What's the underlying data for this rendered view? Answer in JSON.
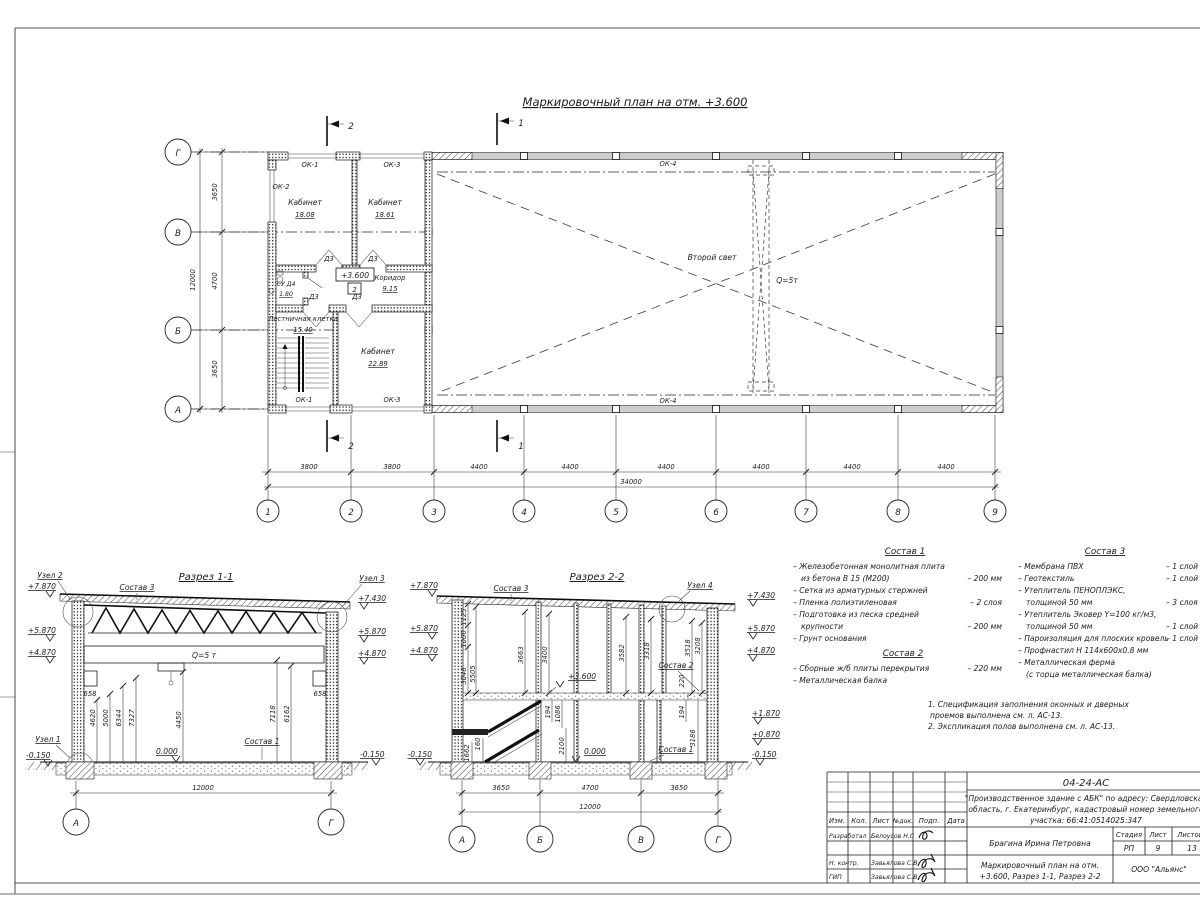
{
  "titles": {
    "plan": "Маркировочный план на отм. +3.600",
    "section1": "Разрез 1-1",
    "section2": "Разрез 2-2"
  },
  "plan": {
    "rooms": {
      "kab1_name": "Кабинет",
      "kab1_area": "18.08",
      "kab2_name": "Кабинет",
      "kab2_area": "18.61",
      "su_name": "СУ Д4",
      "su_area": "1.80",
      "corridor_name": "Коридор",
      "corridor_area": "9.15",
      "stair_name": "Лестничная клетка",
      "stair_area": "15.40",
      "kab3_name": "Кабинет",
      "kab3_area": "22.89"
    },
    "window_ok1": "ОК-1",
    "window_ok2": "ОК-2",
    "window_ok3": "ОК-3",
    "window_ok4": "ОК-4",
    "door": "Д3",
    "level_node": "2",
    "second_light": "Второй свет",
    "crane": "Q=5т",
    "cut1": "1",
    "cut2": "2",
    "axes_bottom": [
      "1",
      "2",
      "3",
      "4",
      "5",
      "6",
      "7",
      "8",
      "9"
    ],
    "axes_left": [
      "Г",
      "В",
      "Б",
      "А"
    ],
    "dims_bottom": [
      "3800",
      "3800",
      "4400",
      "4400",
      "4400",
      "4400",
      "4400",
      "4400"
    ],
    "dims_bottom_total": "34000",
    "dims_left": [
      "3650",
      "4700",
      "3650"
    ],
    "dims_left_total": "12000"
  },
  "levels": {
    "p7870": "+7.870",
    "p7430": "+7.430",
    "p5870": "+5.870",
    "p4870": "+4.870",
    "p3600": "+3.600",
    "p1870": "+1.870",
    "p0870": "+0.870",
    "zero": "0.000",
    "m0150": "-0.150"
  },
  "nodes": {
    "n1": "Узел 1",
    "n2": "Узел 2",
    "n3": "Узел 3",
    "n4": "Узел 4"
  },
  "section1": {
    "crane": "Q=5 т",
    "corbel_dim": "658",
    "dims": [
      "4620",
      "5000",
      "6344",
      "7327",
      "4450",
      "7118",
      "6162"
    ],
    "dim_total": "12000"
  },
  "section2": {
    "dims_upper": [
      "1125",
      "1000",
      "3048",
      "5505",
      "3663",
      "3400",
      "3582",
      "3318",
      "3518",
      "3208",
      "220"
    ],
    "dims_lower": [
      "194",
      "1086",
      "2100",
      "160",
      "1662",
      "194",
      "3186"
    ],
    "dims_bottom": [
      "3650",
      "4700",
      "3650"
    ],
    "dim_total": "12000"
  },
  "comps": {
    "c1_title": "Состав 1",
    "c1": [
      {
        "t": "– Железобетонная  монолитная плита",
        "v": ""
      },
      {
        "t": "из бетона В 15 (М200)",
        "v": "– 200 мм"
      },
      {
        "t": "– Сетка из арматурных стержней",
        "v": ""
      },
      {
        "t": "– Пленка полиэтиленовая",
        "v": "– 2 слоя"
      },
      {
        "t": "– Подготовка из песка средней",
        "v": ""
      },
      {
        "t": "крупности",
        "v": "– 200 мм"
      },
      {
        "t": "– Грунт основания",
        "v": ""
      }
    ],
    "c2_title": "Состав 2",
    "c2": [
      {
        "t": "– Сборные ж/б плиты перекрытия",
        "v": "– 220 мм"
      },
      {
        "t": "– Металлическая балка",
        "v": ""
      }
    ],
    "c3_title": "Состав 3",
    "c3": [
      {
        "t": "– Мембрана ПВХ",
        "v": "– 1 слой"
      },
      {
        "t": "– Геотекстиль",
        "v": "– 1 слой"
      },
      {
        "t": "– Утеплитель ПЕНОПЛЭКС,",
        "v": ""
      },
      {
        "t": "толщиной 50 мм",
        "v": "– 3 слоя"
      },
      {
        "t": "– Утеплитель Эковер Y=100 кг/м3,",
        "v": ""
      },
      {
        "t": "толщиной 50 мм",
        "v": "– 1 слой"
      },
      {
        "t": "– Пароизоляция для плоских кровель",
        "v": "– 1 слой"
      },
      {
        "t": "– Профнастил Н 114х600х0.8 мм",
        "v": ""
      },
      {
        "t": "– Металлическая ферма",
        "v": ""
      },
      {
        "t": "(с торца металлическая балка)",
        "v": ""
      }
    ]
  },
  "notes": [
    "1. Спецификация заполнения оконных и дверных",
    "проемов выполнена см. л. АС-13.",
    "2. Экспликация полов выполнена см. л. АС-13."
  ],
  "titleblock": {
    "code": "04-24-АС",
    "project_line1": "\"Производственное здание с АБК\" по адресу: Свердловская",
    "project_line2": "область, г. Екатеринбург, кадастровый номер земельного",
    "project_line3": "участка: 66:41:0514025:347",
    "cols": [
      "Изм.",
      "Кол.",
      "Лист",
      "№док.",
      "Подп.",
      "Дата"
    ],
    "row1_role": "Разработал",
    "row1_name": "Белоусов Н.С",
    "row2_role": "Н. контр.",
    "row2_name": "Завьялова С.В",
    "row3_role": "ГИП",
    "row3_name": "Завьялова С.В",
    "author": "Брагина Ирина Петровна",
    "stage_label": "Стадия",
    "sheet_label": "Лист",
    "sheets_label": "Листов",
    "stage": "РП",
    "sheet_no": "9",
    "sheets_total": "13",
    "doc_title1": "Маркировочный план на отм.",
    "doc_title2": "+3.600, Разрез 1-1, Разрез 2-2",
    "company": "ООО \"Альянс\""
  }
}
